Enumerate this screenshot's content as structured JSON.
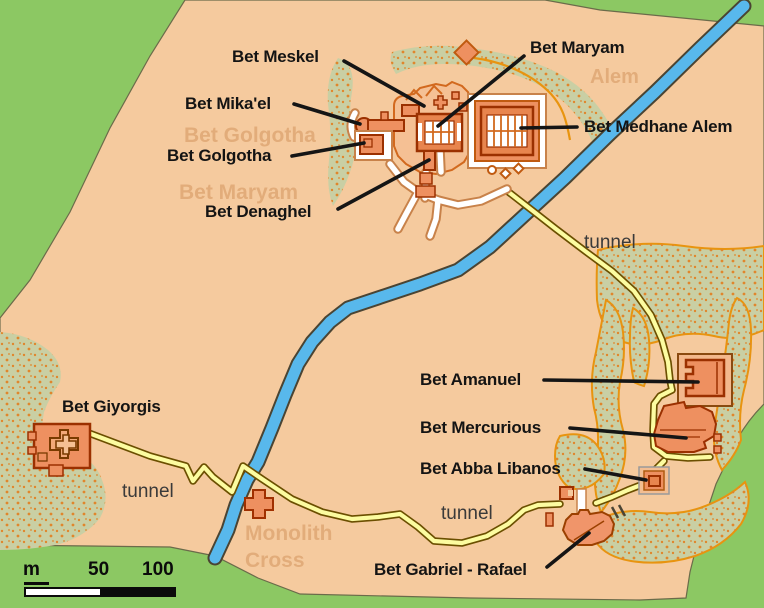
{
  "labels": {
    "meskel": "Bet Meskel",
    "maryam": "Bet Maryam",
    "mikael": "Bet Mika'el",
    "golgotha": "Bet Golgotha",
    "denaghel": "Bet Denaghel",
    "medhane_alem": "Bet Medhane Alem",
    "amanuel": "Bet Amanuel",
    "mercurious": "Bet Mercurious",
    "abba_libanos": "Bet Abba Libanos",
    "gabriel_rafael": "Bet Gabriel - Rafael",
    "giyorgis": "Bet Giyorgis",
    "tunnel": "tunnel"
  },
  "ghost_labels": {
    "golgotha": "Bet Golgotha",
    "maryam": "Bet Maryam",
    "alem": "Alem",
    "monolith": "Monolith",
    "cross": "Cross"
  },
  "scale_bar": {
    "unit": "m",
    "mid_value": "50",
    "max_value": "100"
  },
  "colors": {
    "background_green": "#8cc863",
    "map_tan": "#f5ca9e",
    "vegetation": "#c9cfa4",
    "vegetation_speckle": "#e0862c",
    "river_blue": "#58b8ec",
    "tunnel_yellow": "#fcfca0",
    "tunnel_casing": "#6b4f00",
    "church_fill": "#ee9060",
    "church_outline": "#9b3000",
    "path_white": "#ffffff",
    "path_casing": "#c8824a",
    "orange_line": "#e8940f",
    "complex_outline": "#d2691e",
    "label_color": "#141414"
  }
}
